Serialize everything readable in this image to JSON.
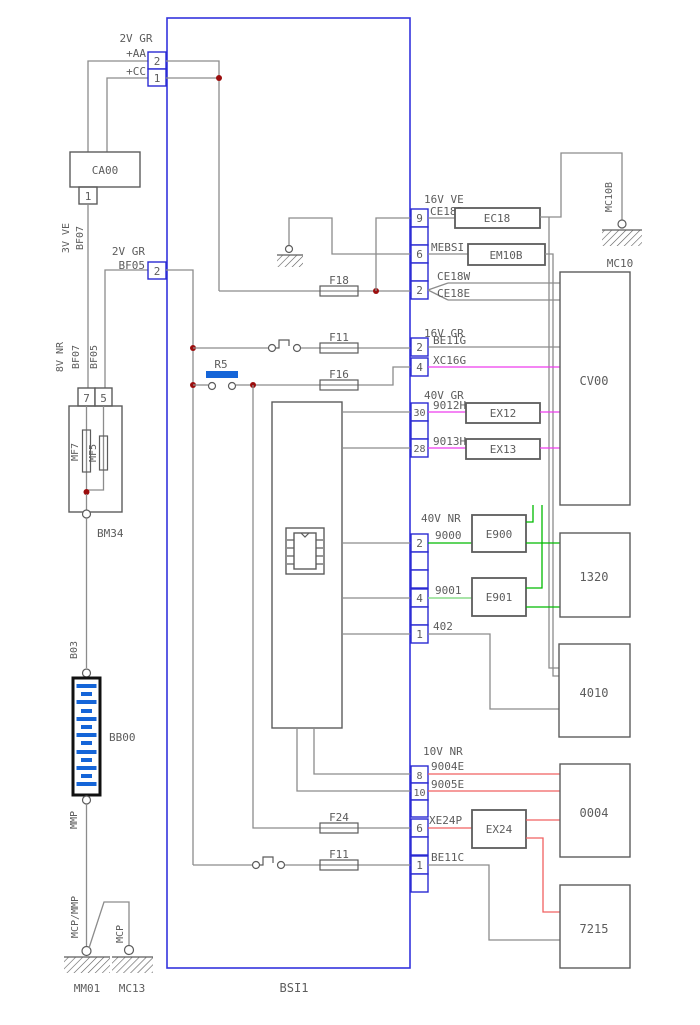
{
  "colors": {
    "wire": "#8c8c8c",
    "outline": "#5c5c5c",
    "text": "#5c5c5c",
    "bsi_border": "#3434dd",
    "pin_box": "#2a2ad2",
    "magenta": "#ee3cee",
    "green": "#00bb00",
    "light_green": "#8cdc8c",
    "red": "#f06060",
    "junction": "#9b0d0d",
    "component_blue": "#1565d8"
  },
  "bsi": {
    "label": "BSI1"
  },
  "top_conn": {
    "group": "2V GR",
    "aa": "+AA",
    "aa_pin": "2",
    "cc": "+CC",
    "cc_pin": "1"
  },
  "ca00": {
    "label": "CA00",
    "pin": "1"
  },
  "bf07": {
    "l1": "3V VE",
    "l2": "BF07"
  },
  "bf05": {
    "l1": "2V GR",
    "l2": "BF05",
    "pin": "2"
  },
  "v8": {
    "l1": "8V NR",
    "l2": "BF07",
    "l3": "BF05"
  },
  "mf": {
    "pin7": "7",
    "pin5": "5",
    "mf7": "MF7",
    "mf5": "MF5",
    "conn": "BM34"
  },
  "bat": {
    "top": "B03",
    "label": "BB00",
    "bottom": "MMP"
  },
  "gnd_left": {
    "strap": "MCP/MMP",
    "mcp": "MCP",
    "g1": "MM01",
    "g2": "MC13"
  },
  "internals": {
    "r5": "R5",
    "f18": "F18",
    "f11a": "F11",
    "f16": "F16",
    "f24": "F24",
    "f11b": "F11"
  },
  "right": {
    "g1": "16V VE",
    "ce18p": "CE18P",
    "p9": "9",
    "mebsi": "MEBSI",
    "p6": "6",
    "ce18w": "CE18W",
    "ce18e": "CE18E",
    "p2a": "2",
    "g2": "16V GR",
    "be11g": "BE11G",
    "p2b": "2",
    "xc16g": "XC16G",
    "p4a": "4",
    "g3": "40V GR",
    "h12": "9012H",
    "p30": "30",
    "h13": "9013H",
    "p28": "28",
    "g4": "40V NR",
    "w9000": "9000",
    "p2c": "2",
    "w9001": "9001",
    "p4b": "4",
    "w402": "402",
    "p1a": "1",
    "g5": "10V NR",
    "w9004": "9004E",
    "p8": "8",
    "w9005": "9005E",
    "p10": "10",
    "xe24p": "XE24P",
    "p6b": "6",
    "be11c": "BE11C",
    "p1b": "1"
  },
  "splices": {
    "ec18": "EC18",
    "em10b": "EM10B",
    "ex12": "EX12",
    "ex13": "EX13",
    "e900": "E900",
    "e901": "E901",
    "ex24": "EX24"
  },
  "mc10": {
    "wire": "MC10B",
    "label": "MC10"
  },
  "boxes": {
    "cv00": "CV00",
    "b1320": "1320",
    "b4010": "4010",
    "b0004": "0004",
    "b7215": "7215"
  }
}
